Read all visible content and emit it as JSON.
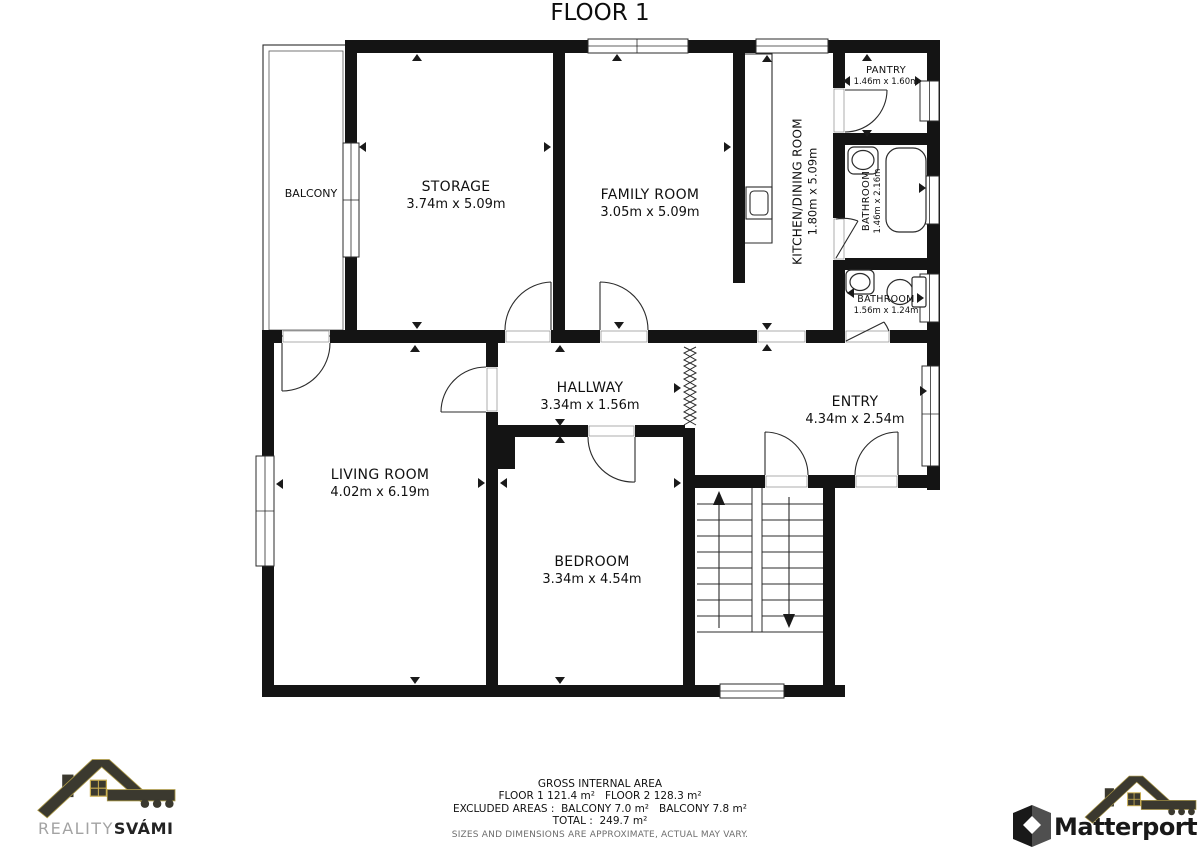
{
  "title": "FLOOR 1",
  "rooms": {
    "balcony": {
      "name": "BALCONY",
      "dims": ""
    },
    "storage": {
      "name": "STORAGE",
      "dims": "3.74m x 5.09m"
    },
    "family": {
      "name": "FAMILY ROOM",
      "dims": "3.05m x 5.09m"
    },
    "kitchen": {
      "name": "KITCHEN/DINING ROOM",
      "dims": "1.80m x 5.09m"
    },
    "pantry": {
      "name": "PANTRY",
      "dims": "1.46m x 1.60m"
    },
    "bathroom1": {
      "name": "BATHROOM",
      "dims": "1.46m x 2.16m"
    },
    "bathroom2": {
      "name": "BATHROOM",
      "dims": "1.56m x 1.24m"
    },
    "hallway": {
      "name": "HALLWAY",
      "dims": "3.34m x 1.56m"
    },
    "entry": {
      "name": "ENTRY",
      "dims": "4.34m x 2.54m"
    },
    "living": {
      "name": "LIVING ROOM",
      "dims": "4.02m x 6.19m"
    },
    "bedroom": {
      "name": "BEDROOM",
      "dims": "3.34m x 4.54m"
    }
  },
  "footer": {
    "gross_label": "GROSS INTERNAL AREA",
    "line_floors": "FLOOR 1 121.4 m²   FLOOR 2 128.3 m²",
    "line_excluded": "EXCLUDED AREAS :  BALCONY 7.0 m²   BALCONY 7.8 m²",
    "line_total": "TOTAL :  249.7 m²",
    "disclaimer": "SIZES AND DIMENSIONS ARE APPROXIMATE, ACTUAL MAY VARY."
  },
  "branding": {
    "agency_light": "REALITY",
    "agency_bold": "SVÁMI",
    "matterport": "Matterport"
  },
  "colors": {
    "wall": "#141414",
    "line": "#2b2b2b",
    "text": "#101010",
    "muted": "#6e6e6e",
    "logo_dark": "#3b392f",
    "logo_gold": "#a99645"
  }
}
